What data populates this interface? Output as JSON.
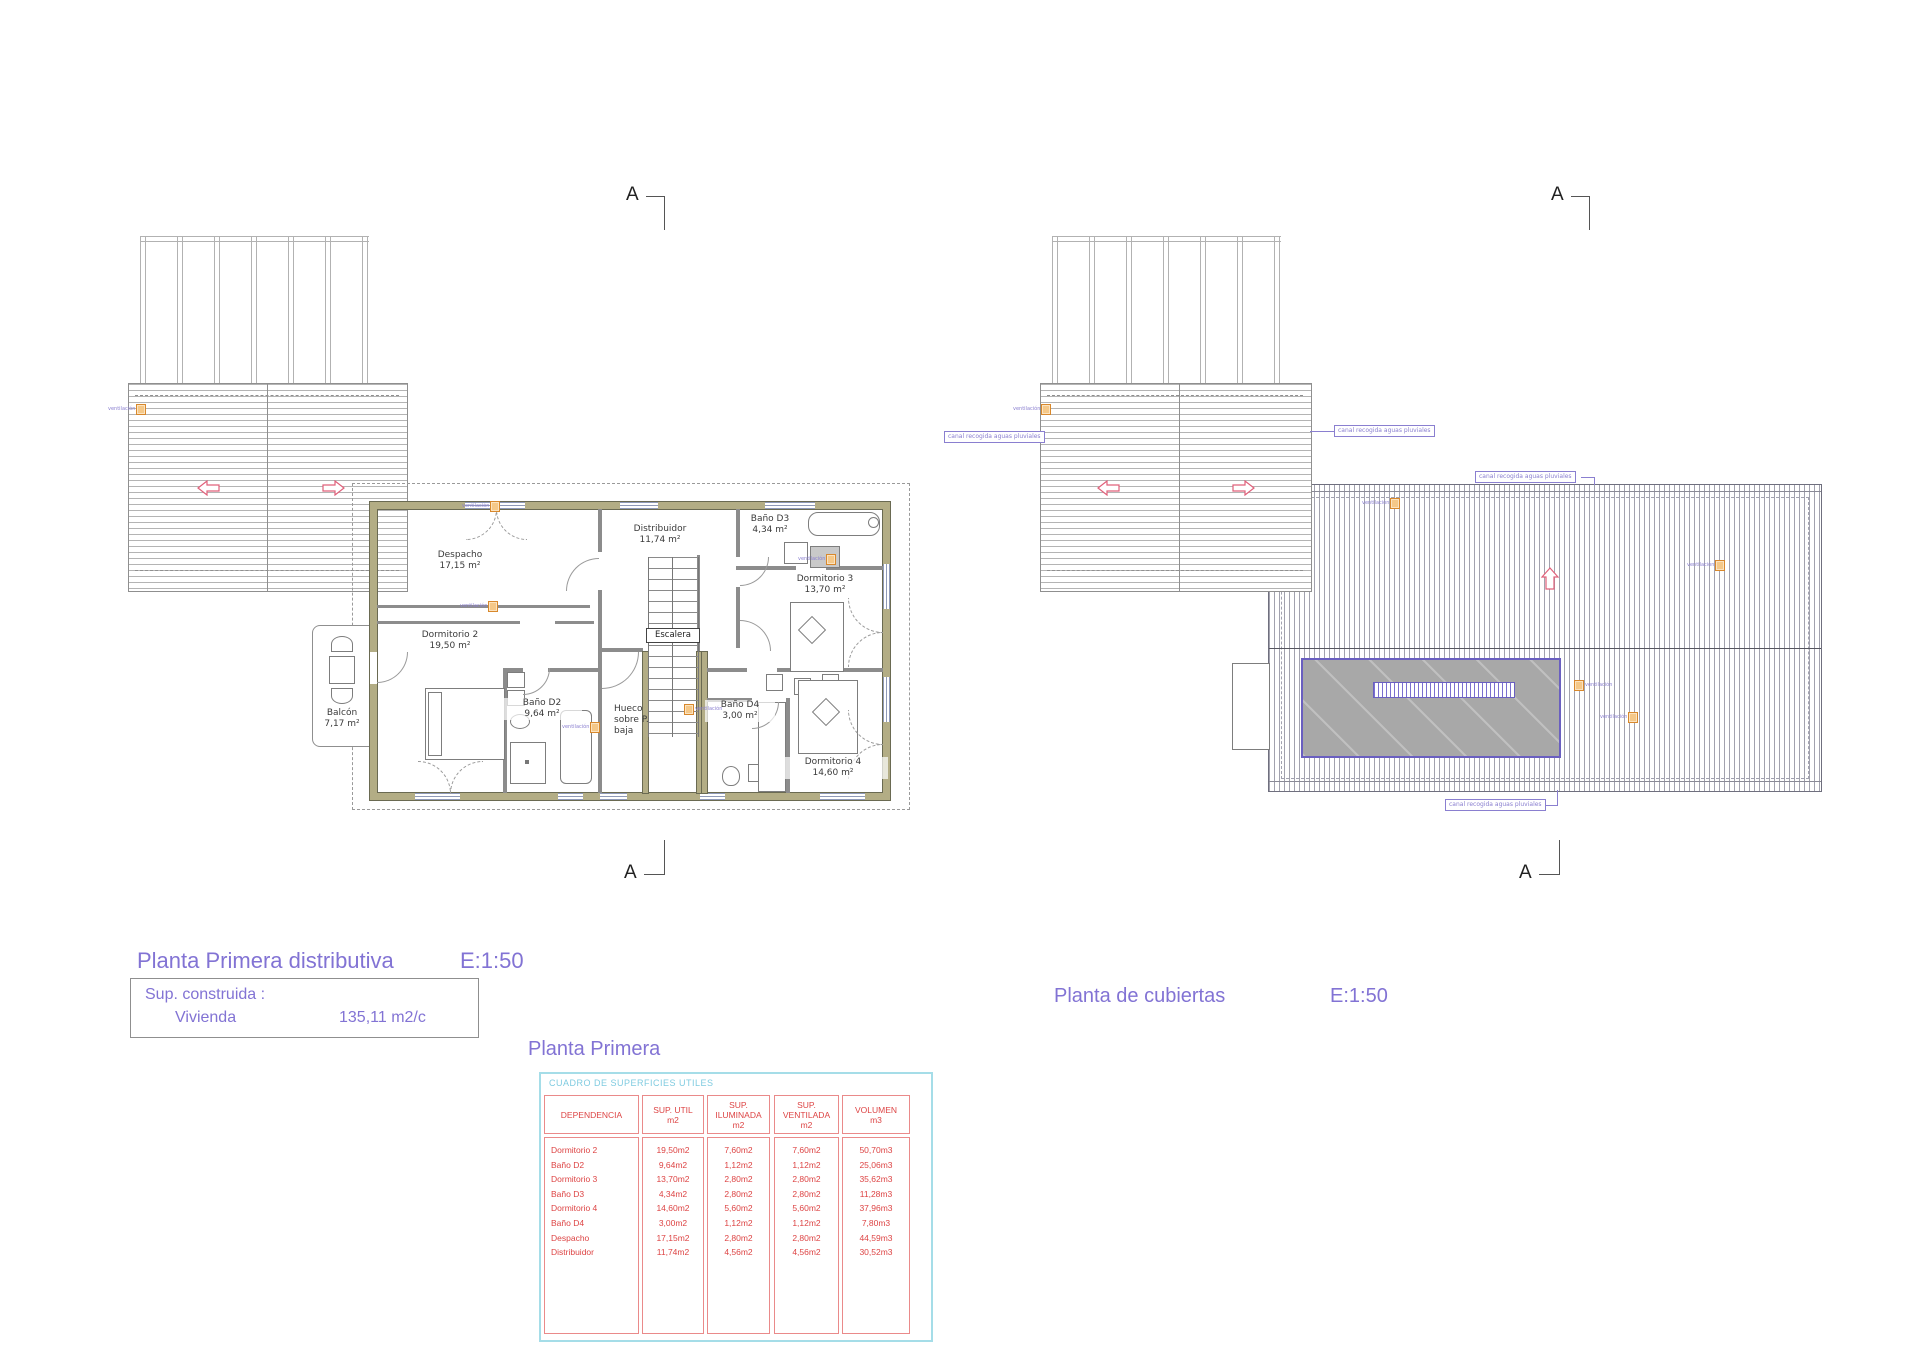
{
  "left_plan": {
    "title": "Planta Primera distributiva",
    "scale": "E:1:50",
    "section_marker": "A",
    "sup_box": {
      "line1": "Sup. construida :",
      "label": "Vivienda",
      "value": "135,11 m2/c"
    },
    "rooms": {
      "despacho": {
        "name": "Despacho",
        "area": "17,15 m²"
      },
      "distribuidor": {
        "name": "Distribuidor",
        "area": "11,74 m²"
      },
      "bano_d3": {
        "name": "Baño D3",
        "area": "4,34 m²"
      },
      "dormitorio3": {
        "name": "Dormitorio 3",
        "area": "13,70 m²"
      },
      "dormitorio2": {
        "name": "Dormitorio 2",
        "area": "19,50 m²"
      },
      "bano_d2": {
        "name": "Baño D2",
        "area": "9,64 m²"
      },
      "hueco": {
        "line1": "Hueco",
        "line2": "sobre P.",
        "line3": "baja"
      },
      "bano_d4": {
        "name": "Baño D4",
        "area": "3,00 m²"
      },
      "dormitorio4": {
        "name": "Dormitorio 4",
        "area": "14,60 m²"
      },
      "escalera": "Escalera",
      "balcon": {
        "name": "Balcón",
        "area": "7,17 m²"
      }
    },
    "vent_label": "ventilación"
  },
  "right_plan": {
    "title": "Planta de cubiertas",
    "scale": "E:1:50",
    "section_marker": "A",
    "gutter_label": "canal recogida aguas pluviales",
    "vent_label": "ventilación"
  },
  "table": {
    "title": "Planta Primera",
    "box_title": "CUADRO DE SUPERFICIES UTILES",
    "headers": [
      [
        "DEPENDENCIA"
      ],
      [
        "SUP. UTIL",
        "m2"
      ],
      [
        "SUP.",
        "ILUMINADA",
        "m2"
      ],
      [
        "SUP.",
        "VENTILADA",
        "m2"
      ],
      [
        "VOLUMEN",
        "m3"
      ]
    ],
    "rows": [
      [
        "Dormitorio 2",
        "19,50m2",
        "7,60m2",
        "7,60m2",
        "50,70m3"
      ],
      [
        "Baño D2",
        "9,64m2",
        "1,12m2",
        "1,12m2",
        "25,06m3"
      ],
      [
        "Dormitorio 3",
        "13,70m2",
        "2,80m2",
        "2,80m2",
        "35,62m3"
      ],
      [
        "Baño D3",
        "4,34m2",
        "2,80m2",
        "2,80m2",
        "11,28m3"
      ],
      [
        "Dormitorio 4",
        "14,60m2",
        "5,60m2",
        "5,60m2",
        "37,96m3"
      ],
      [
        "Baño D4",
        "3,00m2",
        "1,12m2",
        "1,12m2",
        "7,80m3"
      ],
      [
        "Despacho",
        "17,15m2",
        "2,80m2",
        "2,80m2",
        "44,59m3"
      ],
      [
        "Distribuidor",
        "11,74m2",
        "4,56m2",
        "4,56m2",
        "30,52m3"
      ]
    ]
  },
  "colors": {
    "accent_purple": "#8273d4",
    "label_purple": "#8a7fd0",
    "table_red": "#dd4444",
    "table_cyan": "#7fcbe0",
    "wall_olive": "#b3ad85",
    "marker_orange": "#d8882c",
    "arrow_red": "#e0607a"
  }
}
